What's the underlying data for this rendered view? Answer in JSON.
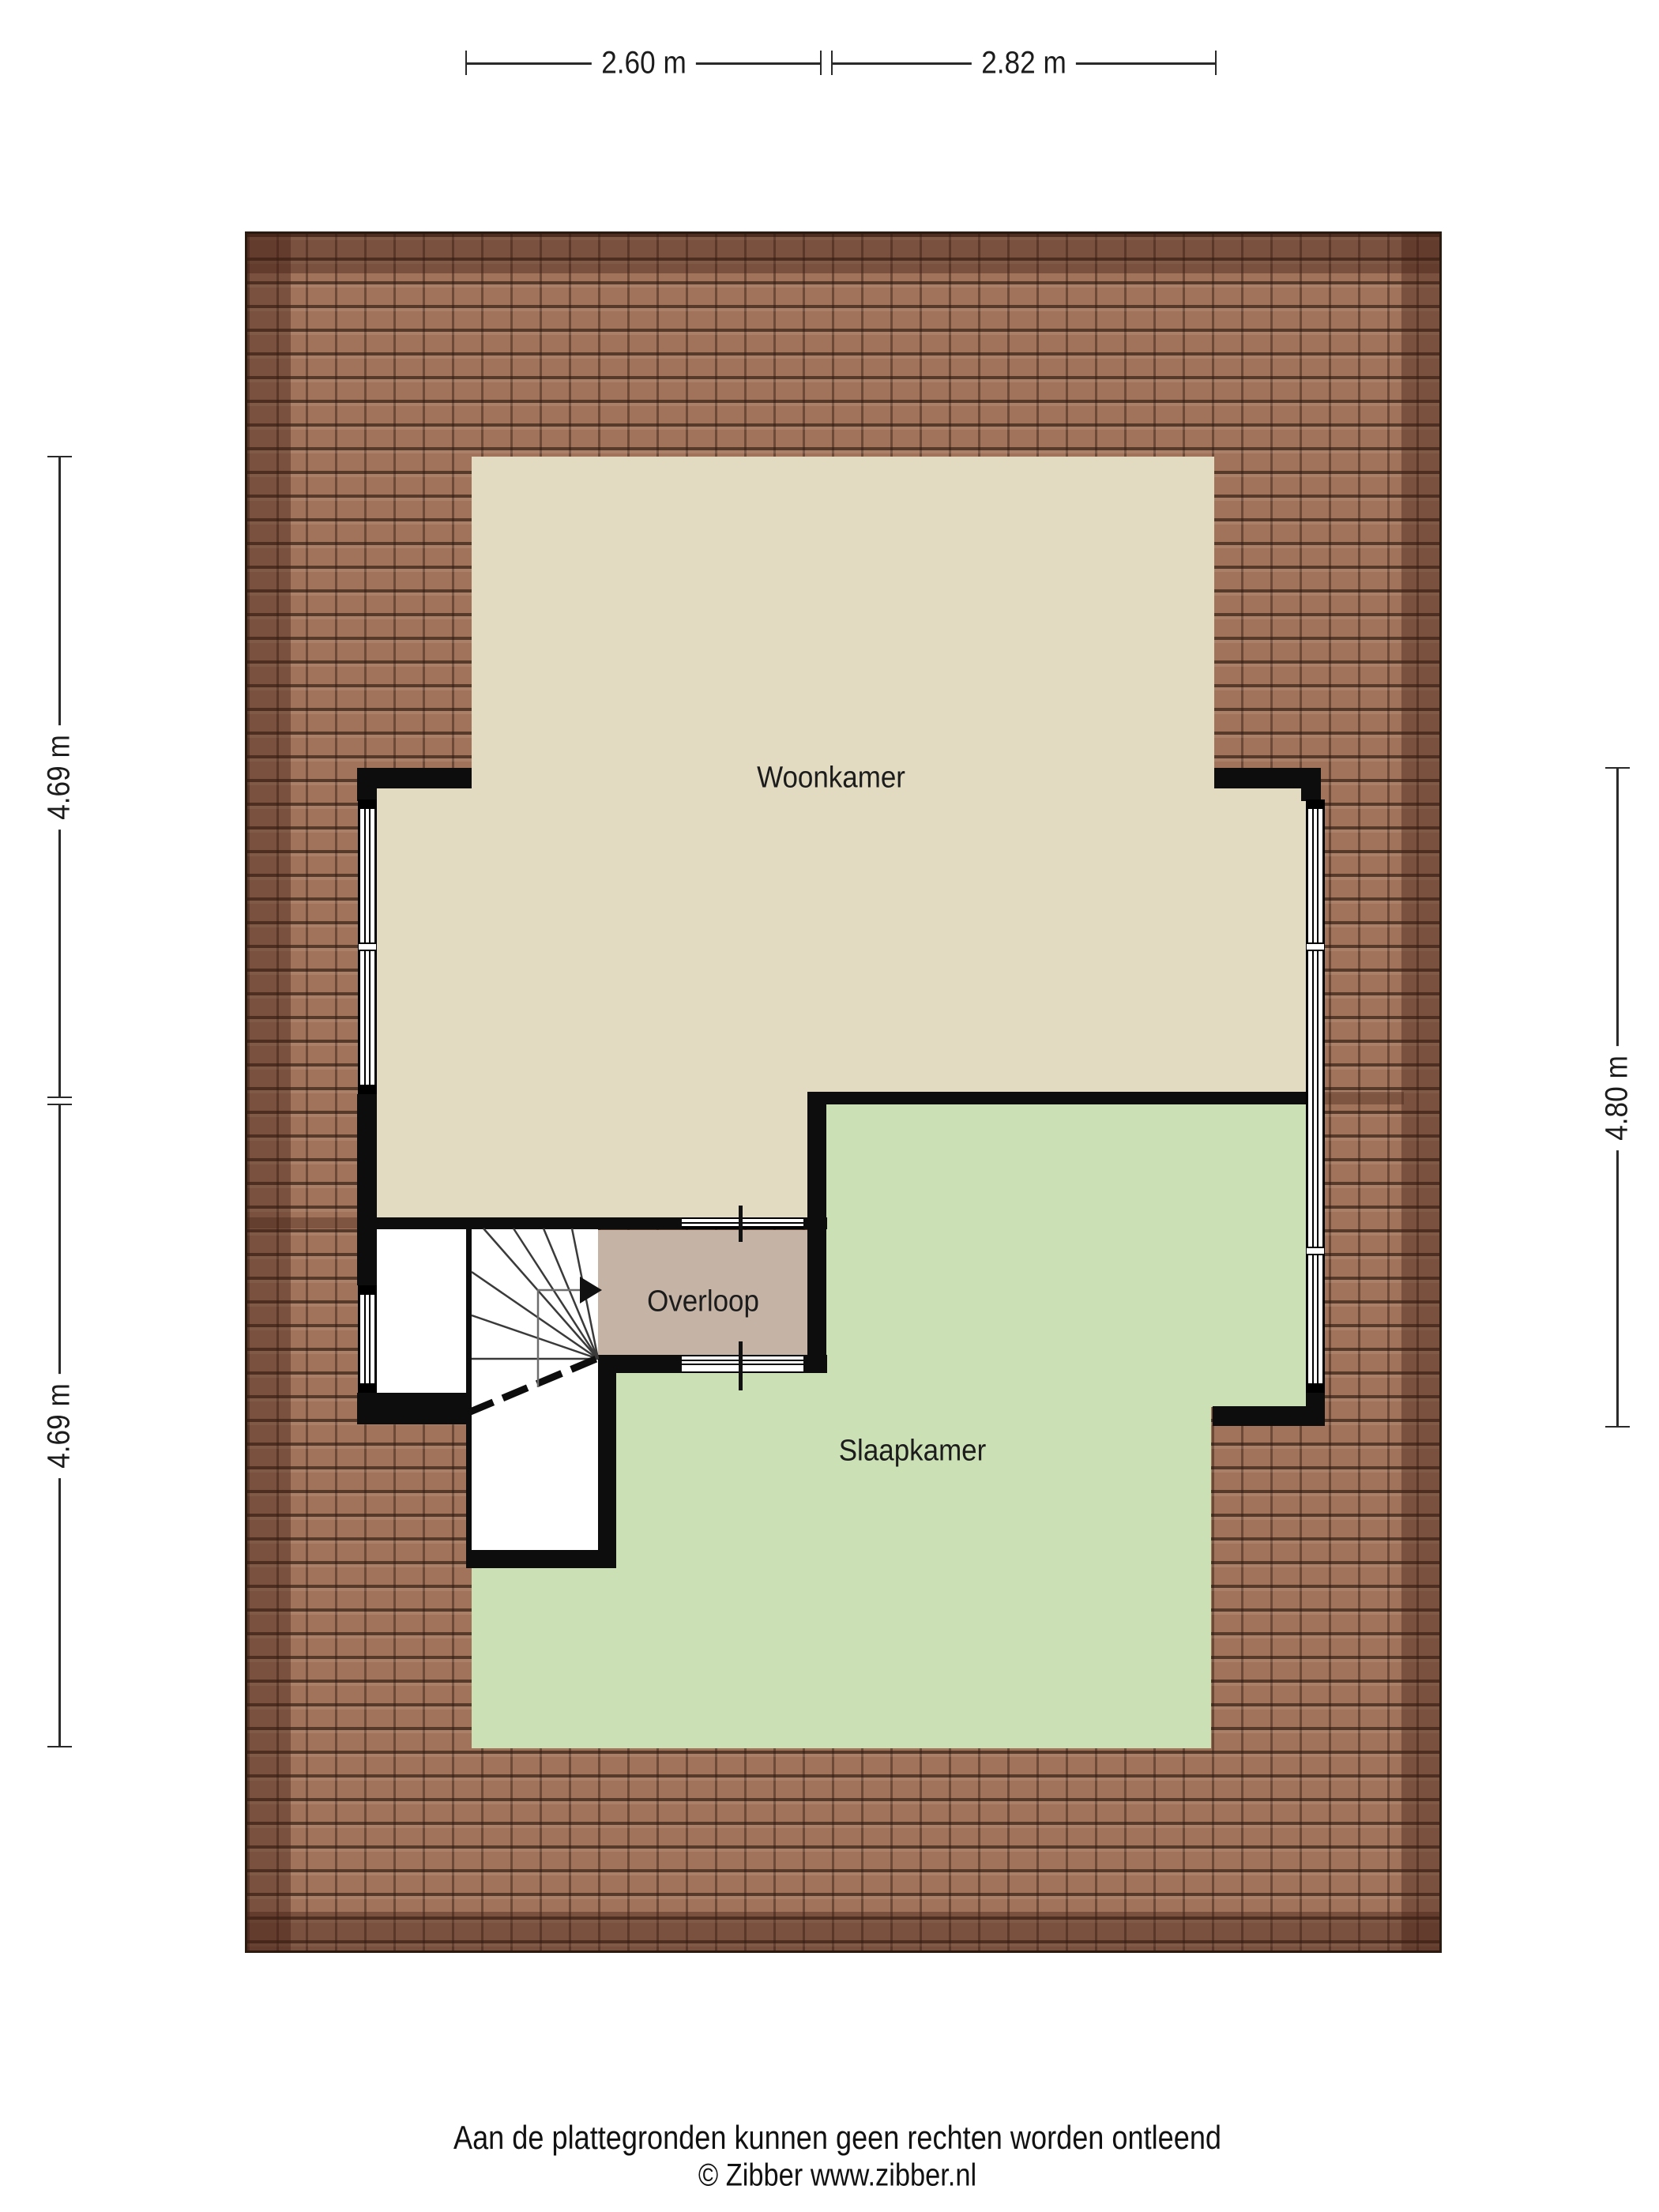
{
  "plan": {
    "type": "floor-plan",
    "floor": "attic",
    "rooms": [
      {
        "id": "woonkamer",
        "label": "Woonkamer",
        "floor_color": "#e2dbc1"
      },
      {
        "id": "overloop",
        "label": "Overloop",
        "floor_color": "#c5b4a6"
      },
      {
        "id": "slaapkamer",
        "label": "Slaapkamer",
        "floor_color": "#cbe0b5"
      }
    ],
    "features": [
      "winder-staircase",
      "stair-direction-arrow",
      "roof-tiles",
      "window-strips",
      "wall-openings"
    ]
  },
  "dimensions": {
    "top": [
      {
        "label": "2.60 m"
      },
      {
        "label": "2.82 m"
      }
    ],
    "left": [
      {
        "label": "4.69 m"
      },
      {
        "label": "4.69 m"
      }
    ],
    "right": [
      {
        "label": "4.80 m"
      }
    ]
  },
  "footer": {
    "disclaimer": "Aan de plattegronden kunnen geen rechten worden ontleend",
    "copyright": "© Zibber www.zibber.nl"
  },
  "colors": {
    "floor_beige": "#e2dbc1",
    "floor_green": "#cbe0b5",
    "floor_taupe": "#c5b4a6",
    "wall": "#0d0d0d",
    "roof_base": "#a1735a",
    "roof_band": "rgba(64,31,19,0.40)",
    "text": "#1c1c1c"
  }
}
